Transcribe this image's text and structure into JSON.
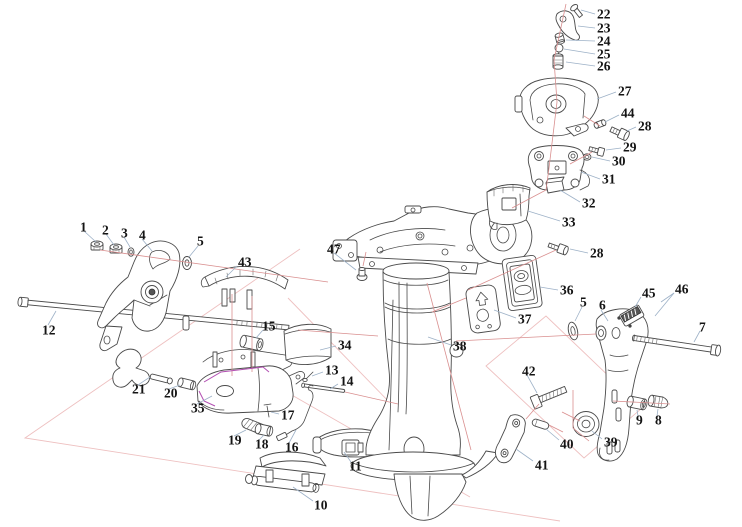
{
  "diagram": {
    "type": "exploded-parts-diagram",
    "canvas": {
      "width": 742,
      "height": 527
    },
    "colors": {
      "background": "#ffffff",
      "part_outline": "#4a4a4a",
      "leader_line": "#9db1c7",
      "axis_line": "#d98f8f",
      "plane_line": "#eec0c0",
      "highlight_line": "#b24fb2",
      "label_text": "#141414"
    },
    "callouts": [
      {
        "part": "22",
        "x": 597,
        "y": 14,
        "leaders": [
          [
            595,
            14,
            581,
            10
          ]
        ]
      },
      {
        "part": "23",
        "x": 597,
        "y": 28,
        "leaders": [
          [
            595,
            28,
            578,
            26
          ]
        ]
      },
      {
        "part": "24",
        "x": 597,
        "y": 41,
        "leaders": [
          [
            595,
            41,
            566,
            40
          ]
        ]
      },
      {
        "part": "25",
        "x": 597,
        "y": 54,
        "leaders": [
          [
            595,
            54,
            564,
            49
          ]
        ]
      },
      {
        "part": "26",
        "x": 597,
        "y": 66,
        "leaders": [
          [
            595,
            66,
            566,
            62
          ]
        ]
      },
      {
        "part": "27",
        "x": 618,
        "y": 91,
        "leaders": [
          [
            616,
            92,
            597,
            99
          ]
        ]
      },
      {
        "part": "44",
        "x": 621,
        "y": 113,
        "leaders": [
          [
            619,
            115,
            605,
            122
          ]
        ]
      },
      {
        "part": "28",
        "x": 638,
        "y": 126,
        "leaders": [
          [
            636,
            127,
            627,
            131
          ]
        ]
      },
      {
        "part": "29",
        "x": 623,
        "y": 147,
        "leaders": [
          [
            621,
            148,
            606,
            150
          ]
        ]
      },
      {
        "part": "30",
        "x": 612,
        "y": 161,
        "leaders": [
          [
            610,
            161,
            592,
            157
          ]
        ]
      },
      {
        "part": "31",
        "x": 602,
        "y": 179,
        "leaders": [
          [
            600,
            179,
            581,
            172
          ]
        ]
      },
      {
        "part": "32",
        "x": 582,
        "y": 203,
        "leaders": [
          [
            580,
            202,
            560,
            190
          ]
        ]
      },
      {
        "part": "33",
        "x": 562,
        "y": 222,
        "leaders": [
          [
            560,
            221,
            528,
            211
          ]
        ]
      },
      {
        "part": "1",
        "x": 80,
        "y": 227,
        "leaders": [
          [
            84,
            231,
            96,
            242
          ]
        ]
      },
      {
        "part": "2",
        "x": 102,
        "y": 230,
        "leaders": [
          [
            106,
            234,
            114,
            245
          ]
        ]
      },
      {
        "part": "3",
        "x": 121,
        "y": 233,
        "leaders": [
          [
            124,
            237,
            130,
            247
          ]
        ]
      },
      {
        "part": "4",
        "x": 139,
        "y": 235,
        "leaders": [
          [
            142,
            239,
            152,
            251
          ]
        ]
      },
      {
        "part": "5",
        "x": 197,
        "y": 241,
        "leaders": [
          [
            198,
            246,
            189,
            257
          ]
        ]
      },
      {
        "part": "43",
        "x": 238,
        "y": 262,
        "leaders": [
          [
            237,
            266,
            226,
            277
          ]
        ]
      },
      {
        "part": "12",
        "x": 42,
        "y": 330,
        "leaders": [
          [
            48,
            325,
            56,
            311
          ]
        ]
      },
      {
        "part": "47",
        "x": 327,
        "y": 249,
        "leaders": [
          [
            334,
            253,
            356,
            270
          ]
        ]
      },
      {
        "part": "28",
        "x": 590,
        "y": 253,
        "leaders": [
          [
            588,
            253,
            570,
            249
          ]
        ]
      },
      {
        "part": "36",
        "x": 560,
        "y": 290,
        "leaders": [
          [
            558,
            290,
            540,
            287
          ]
        ]
      },
      {
        "part": "37",
        "x": 518,
        "y": 319,
        "leaders": [
          [
            516,
            318,
            494,
            310
          ]
        ]
      },
      {
        "part": "5",
        "x": 580,
        "y": 302,
        "leaders": [
          [
            582,
            307,
            575,
            321
          ]
        ]
      },
      {
        "part": "6",
        "x": 599,
        "y": 305,
        "leaders": [
          [
            601,
            310,
            608,
            321
          ]
        ]
      },
      {
        "part": "45",
        "x": 642,
        "y": 293,
        "leaders": [
          [
            641,
            297,
            635,
            307
          ]
        ]
      },
      {
        "part": "46",
        "x": 675,
        "y": 289,
        "leaders": [
          [
            674,
            293,
            661,
            302
          ],
          [
            674,
            293,
            655,
            316
          ]
        ]
      },
      {
        "part": "7",
        "x": 699,
        "y": 327,
        "leaders": [
          [
            700,
            331,
            694,
            342
          ]
        ]
      },
      {
        "part": "38",
        "x": 453,
        "y": 346,
        "leaders": [
          [
            451,
            345,
            428,
            337
          ]
        ]
      },
      {
        "part": "34",
        "x": 338,
        "y": 345,
        "leaders": [
          [
            336,
            346,
            320,
            350
          ]
        ]
      },
      {
        "part": "15",
        "x": 262,
        "y": 326,
        "leaders": [
          [
            263,
            330,
            256,
            338
          ]
        ]
      },
      {
        "part": "13",
        "x": 325,
        "y": 370,
        "leaders": [
          [
            323,
            372,
            312,
            376
          ]
        ]
      },
      {
        "part": "14",
        "x": 340,
        "y": 381,
        "leaders": [
          [
            338,
            384,
            330,
            389
          ]
        ]
      },
      {
        "part": "42",
        "x": 522,
        "y": 371,
        "leaders": [
          [
            527,
            375,
            537,
            393
          ]
        ]
      },
      {
        "part": "21",
        "x": 132,
        "y": 389,
        "leaders": [
          [
            138,
            385,
            150,
            377
          ]
        ]
      },
      {
        "part": "20",
        "x": 164,
        "y": 393,
        "leaders": [
          [
            169,
            389,
            180,
            385
          ]
        ]
      },
      {
        "part": "35",
        "x": 191,
        "y": 408,
        "leaders": [
          [
            197,
            404,
            212,
            396
          ]
        ]
      },
      {
        "part": "19",
        "x": 228,
        "y": 440,
        "leaders": [
          [
            234,
            436,
            246,
            430
          ]
        ]
      },
      {
        "part": "18",
        "x": 255,
        "y": 444,
        "leaders": [
          [
            259,
            440,
            264,
            435
          ]
        ]
      },
      {
        "part": "17",
        "x": 281,
        "y": 415,
        "leaders": [
          [
            279,
            414,
            271,
            412
          ]
        ]
      },
      {
        "part": "16",
        "x": 285,
        "y": 447,
        "leaders": [
          [
            289,
            443,
            296,
            430
          ]
        ]
      },
      {
        "part": "40",
        "x": 560,
        "y": 444,
        "leaders": [
          [
            559,
            440,
            546,
            429
          ]
        ]
      },
      {
        "part": "41",
        "x": 535,
        "y": 465,
        "leaders": [
          [
            533,
            461,
            516,
            449
          ]
        ]
      },
      {
        "part": "39",
        "x": 604,
        "y": 442,
        "leaders": [
          [
            602,
            439,
            592,
            431
          ]
        ]
      },
      {
        "part": "9",
        "x": 636,
        "y": 420,
        "leaders": [
          [
            638,
            416,
            637,
            410
          ]
        ]
      },
      {
        "part": "8",
        "x": 655,
        "y": 420,
        "leaders": [
          [
            657,
            416,
            658,
            409
          ]
        ]
      },
      {
        "part": "11",
        "x": 349,
        "y": 466,
        "leaders": [
          [
            351,
            462,
            344,
            452
          ]
        ]
      },
      {
        "part": "10",
        "x": 314,
        "y": 505,
        "leaders": [
          [
            313,
            501,
            293,
            487
          ]
        ]
      }
    ]
  }
}
